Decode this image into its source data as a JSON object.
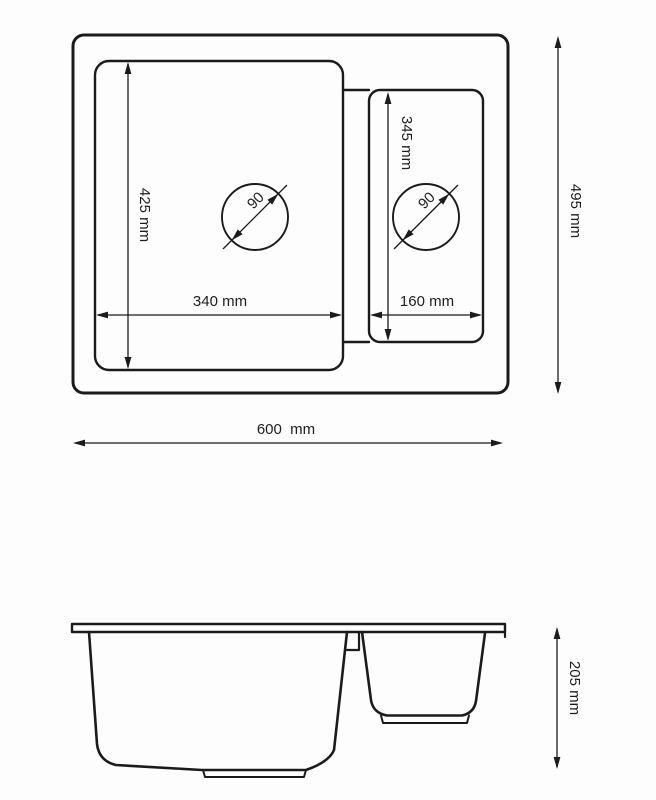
{
  "drawing": {
    "subject": "one-and-a-half bowl kitchen sink dimension drawing",
    "line_color": "#1b1b1b",
    "text_color": "#1d1d1d",
    "background": "#fdfdfd",
    "top_view": {
      "overall_width": "600  mm",
      "overall_depth": "495 mm",
      "main_bowl": {
        "width": "340 mm",
        "length": "425 mm",
        "drain_diameter": "90"
      },
      "half_bowl": {
        "width": "160 mm",
        "length": "345 mm",
        "drain_diameter": "90"
      }
    },
    "side_view": {
      "bowl_depth": "205 mm"
    }
  }
}
